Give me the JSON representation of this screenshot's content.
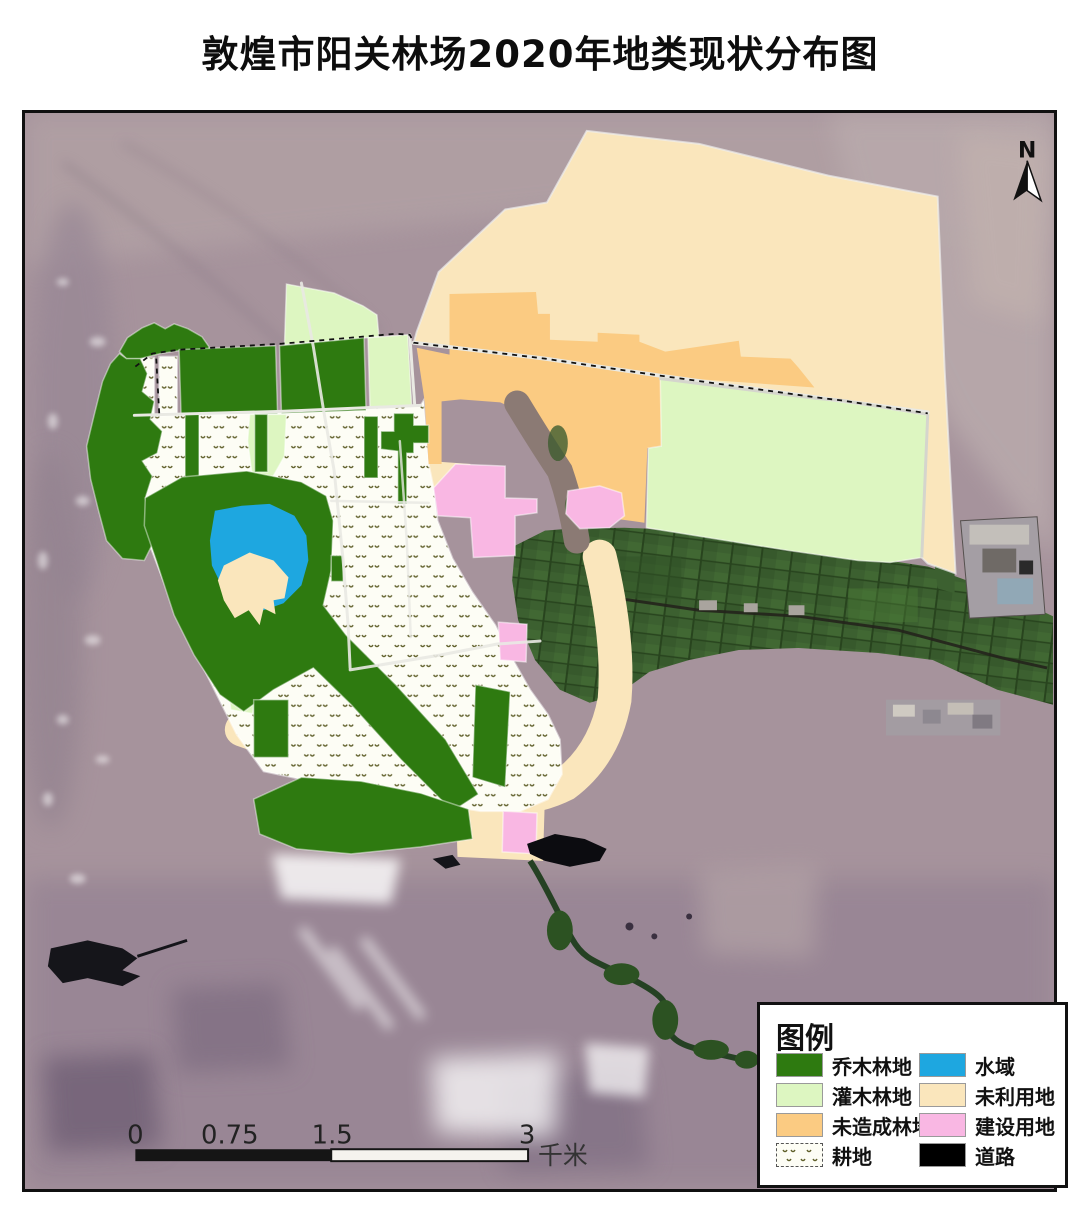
{
  "title": "敦煌市阳关林场2020年地类现状分布图",
  "north": {
    "label": "N"
  },
  "scale_bar": {
    "ticks": [
      "0",
      "0.75",
      "1.5",
      "3"
    ],
    "unit": "千米"
  },
  "legend": {
    "title": "图例",
    "items": [
      {
        "id": "qiaomu",
        "label": "乔木林地",
        "color": "#2e7a10",
        "swatch": "solid"
      },
      {
        "id": "guanmu",
        "label": "灌木林地",
        "color": "#ddf6c1",
        "swatch": "solid"
      },
      {
        "id": "weizaocheng",
        "label": "未造成林地",
        "color": "#fbcb82",
        "swatch": "solid"
      },
      {
        "id": "gengdi",
        "label": "耕地",
        "color": "#fdfdf5",
        "swatch": "dotted-pattern"
      },
      {
        "id": "shuiyu",
        "label": "水域",
        "color": "#1ea7e0",
        "swatch": "solid"
      },
      {
        "id": "weiliyong",
        "label": "未利用地",
        "color": "#fae6bc",
        "swatch": "solid"
      },
      {
        "id": "jianshe",
        "label": "建设用地",
        "color": "#f9b7e3",
        "swatch": "solid"
      },
      {
        "id": "daolu",
        "label": "道路",
        "color": "#000000",
        "swatch": "solid"
      }
    ]
  }
}
